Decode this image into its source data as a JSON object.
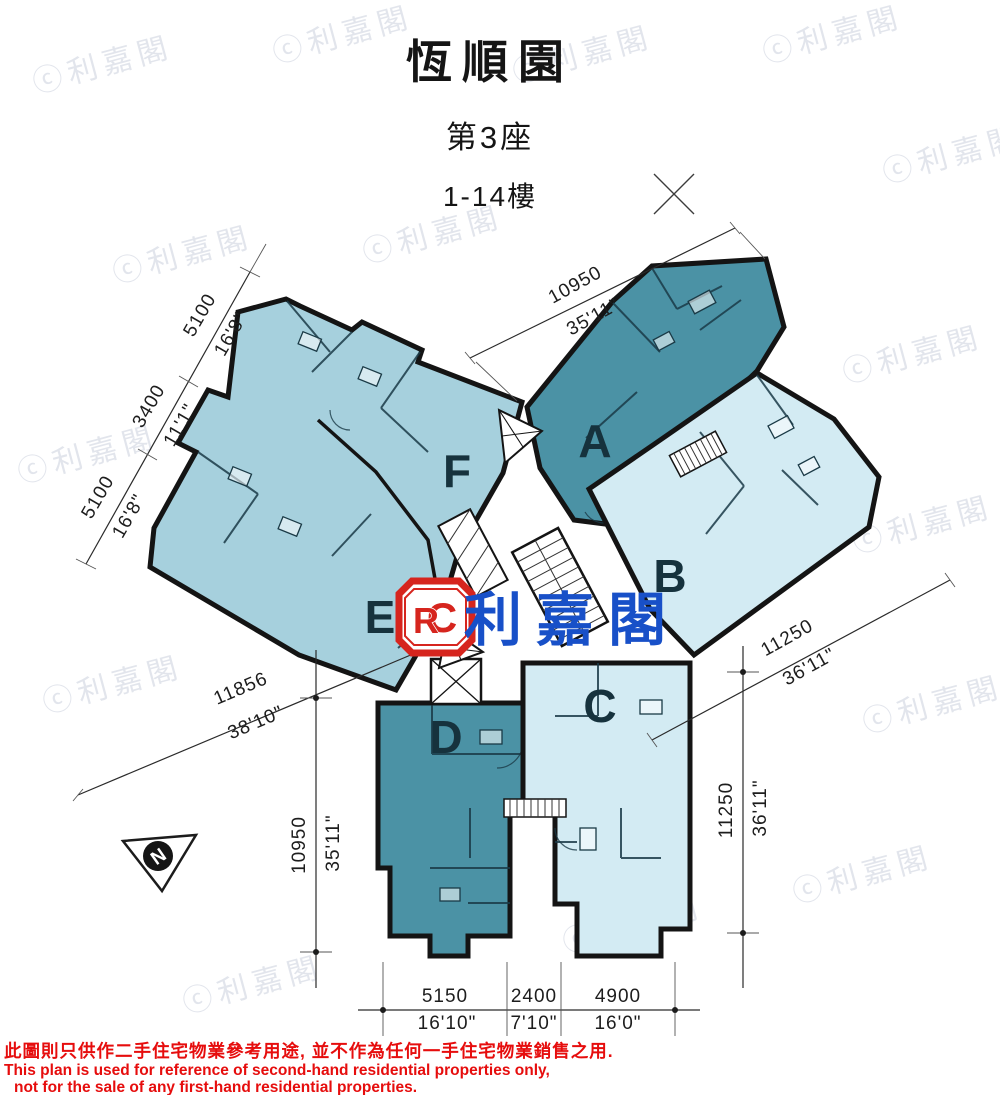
{
  "title": {
    "building": "恆順園",
    "block": "第3座",
    "floors": "1-14樓"
  },
  "units": {
    "a": "A",
    "b": "B",
    "c": "C",
    "d": "D",
    "e": "E",
    "f": "F"
  },
  "dimensions": {
    "top_right": {
      "mm": "10950",
      "ft": "35'11\""
    },
    "left_chain": [
      {
        "mm": "5100",
        "ft": "16'8\""
      },
      {
        "mm": "3400",
        "ft": "11'1\""
      },
      {
        "mm": "5100",
        "ft": "16'8\""
      }
    ],
    "left_diagonal": {
      "mm": "11856",
      "ft": "38'10\""
    },
    "left_vertical": {
      "mm": "10950",
      "ft": "35'11\""
    },
    "right_diagonal": {
      "mm": "11250",
      "ft": "36'11\""
    },
    "right_vertical": {
      "mm": "11250",
      "ft": "36'11\""
    },
    "bottom": [
      {
        "mm": "5150",
        "ft": "16'10\""
      },
      {
        "mm": "2400",
        "ft": "7'10\""
      },
      {
        "mm": "4900",
        "ft": "16'0\""
      }
    ]
  },
  "compass": {
    "label": "N"
  },
  "logo": {
    "r": "R",
    "c": "C",
    "name": "利嘉閣"
  },
  "watermark": {
    "text": "ⓒ利嘉閣"
  },
  "disclaimer": {
    "line1_zh": "此圖則只供作二手住宅物業參考用途, 並不作為任何一手住宅物業銷售之用.",
    "line2_en": "This plan is used for reference of second-hand residential properties only,",
    "line3_en": "not for the sale of any first-hand residential properties."
  },
  "colors": {
    "unit_dark": "#4b92a5",
    "unit_light": "#a6d0dd",
    "unit_pale": "#d3ebf3",
    "wall": "#141414",
    "dimension_text": "#1d1d1d",
    "logo_red": "#d6251e",
    "logo_blue": "#1850c8",
    "disclaimer_red": "#e60d0d"
  }
}
